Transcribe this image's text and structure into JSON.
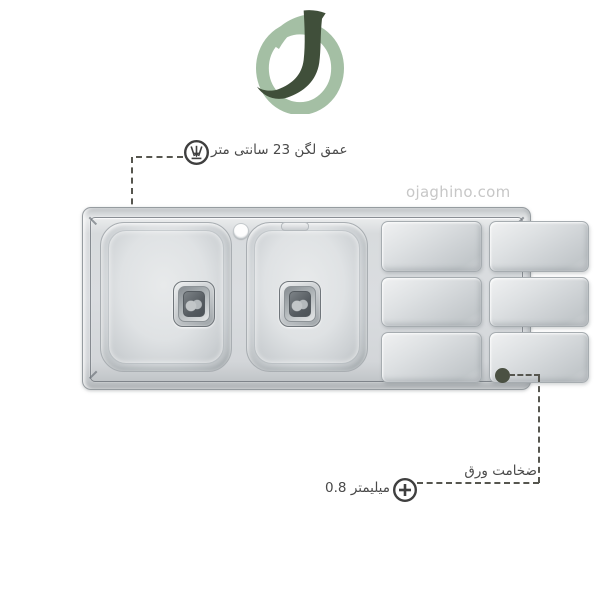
{
  "watermark": {
    "text": "ojaghino.com"
  },
  "logo": {
    "letter": "J"
  },
  "annotations": {
    "depth": {
      "text": "عمق لگن 23 سانتی متر",
      "icon": "depth-gauge-icon"
    },
    "thickness": {
      "label": "ضخامت ورق",
      "value": "0.8 میلیمتر",
      "icon": "plus-circle-icon"
    }
  },
  "sink": {
    "bowl_count": 2,
    "drainboard_square_count": 6,
    "faucet_hole_count": 1
  },
  "colors": {
    "logo_dark_green": "#404f3a",
    "logo_sage_green": "#a4bfa4",
    "annotation_text": "#4a4a4a",
    "annotation_line": "#56564f",
    "annotation_dot": "#4b5143",
    "watermark_gray": "#c7c7c7",
    "steel_base": "#d6d9db"
  }
}
